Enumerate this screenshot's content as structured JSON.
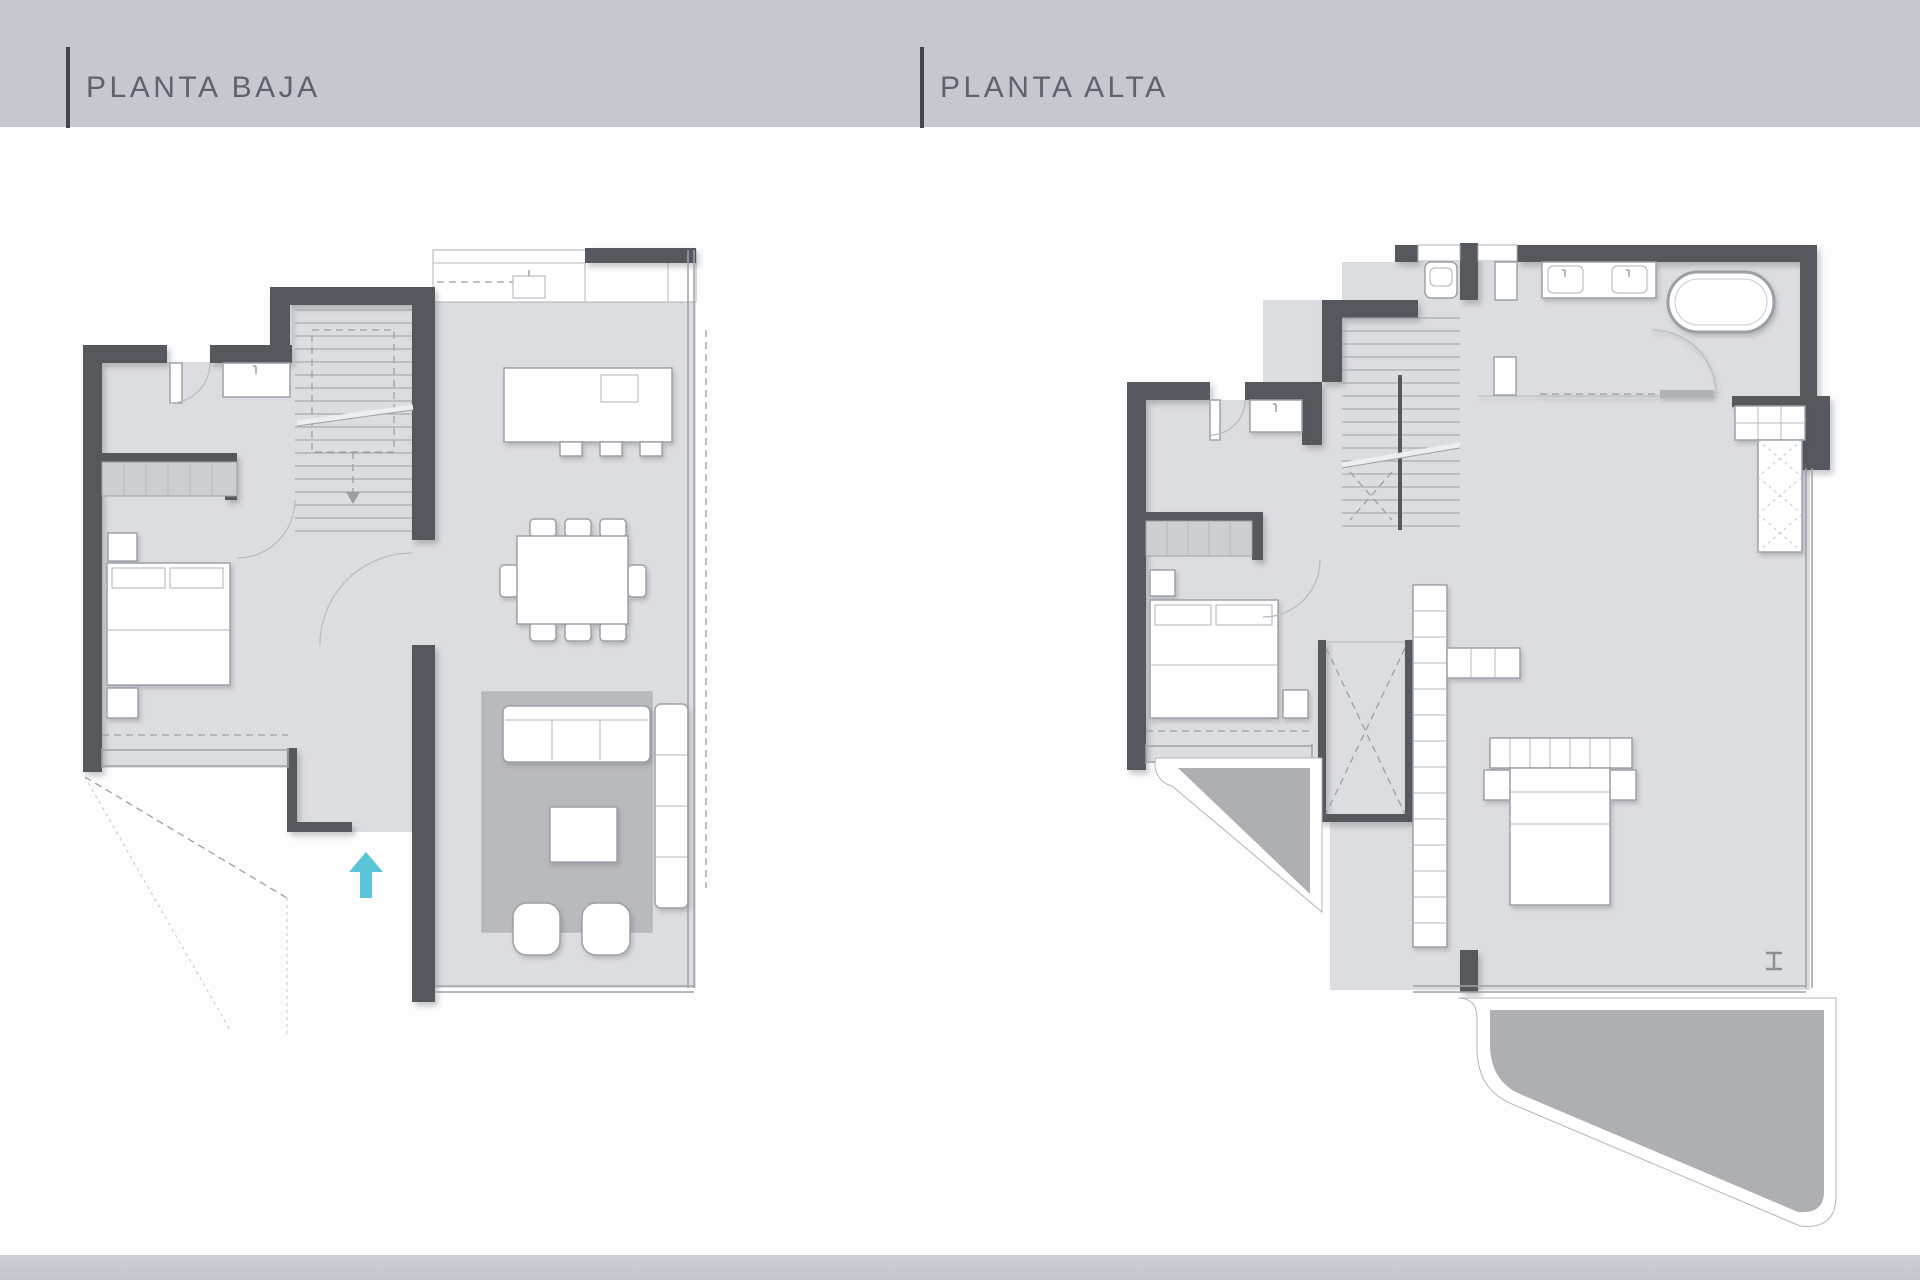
{
  "header": {
    "plans": [
      {
        "id": "planta-baja",
        "title": "PLANTA BAJA"
      },
      {
        "id": "planta-alta",
        "title": "PLANTA ALTA"
      }
    ]
  },
  "colors": {
    "band": "#c5c8cf",
    "title_text": "#5d6470",
    "title_bar": "#41474f",
    "wall": "#55585d",
    "floor": "#dcdde0",
    "rug": "#b9babd",
    "terrace": "#adafb3",
    "closet_fill": "#cdced2",
    "outline": "#9da2a8",
    "entry_arrow": "#59c5d8"
  },
  "icons": {
    "entry_arrow_icon": "⬆"
  }
}
